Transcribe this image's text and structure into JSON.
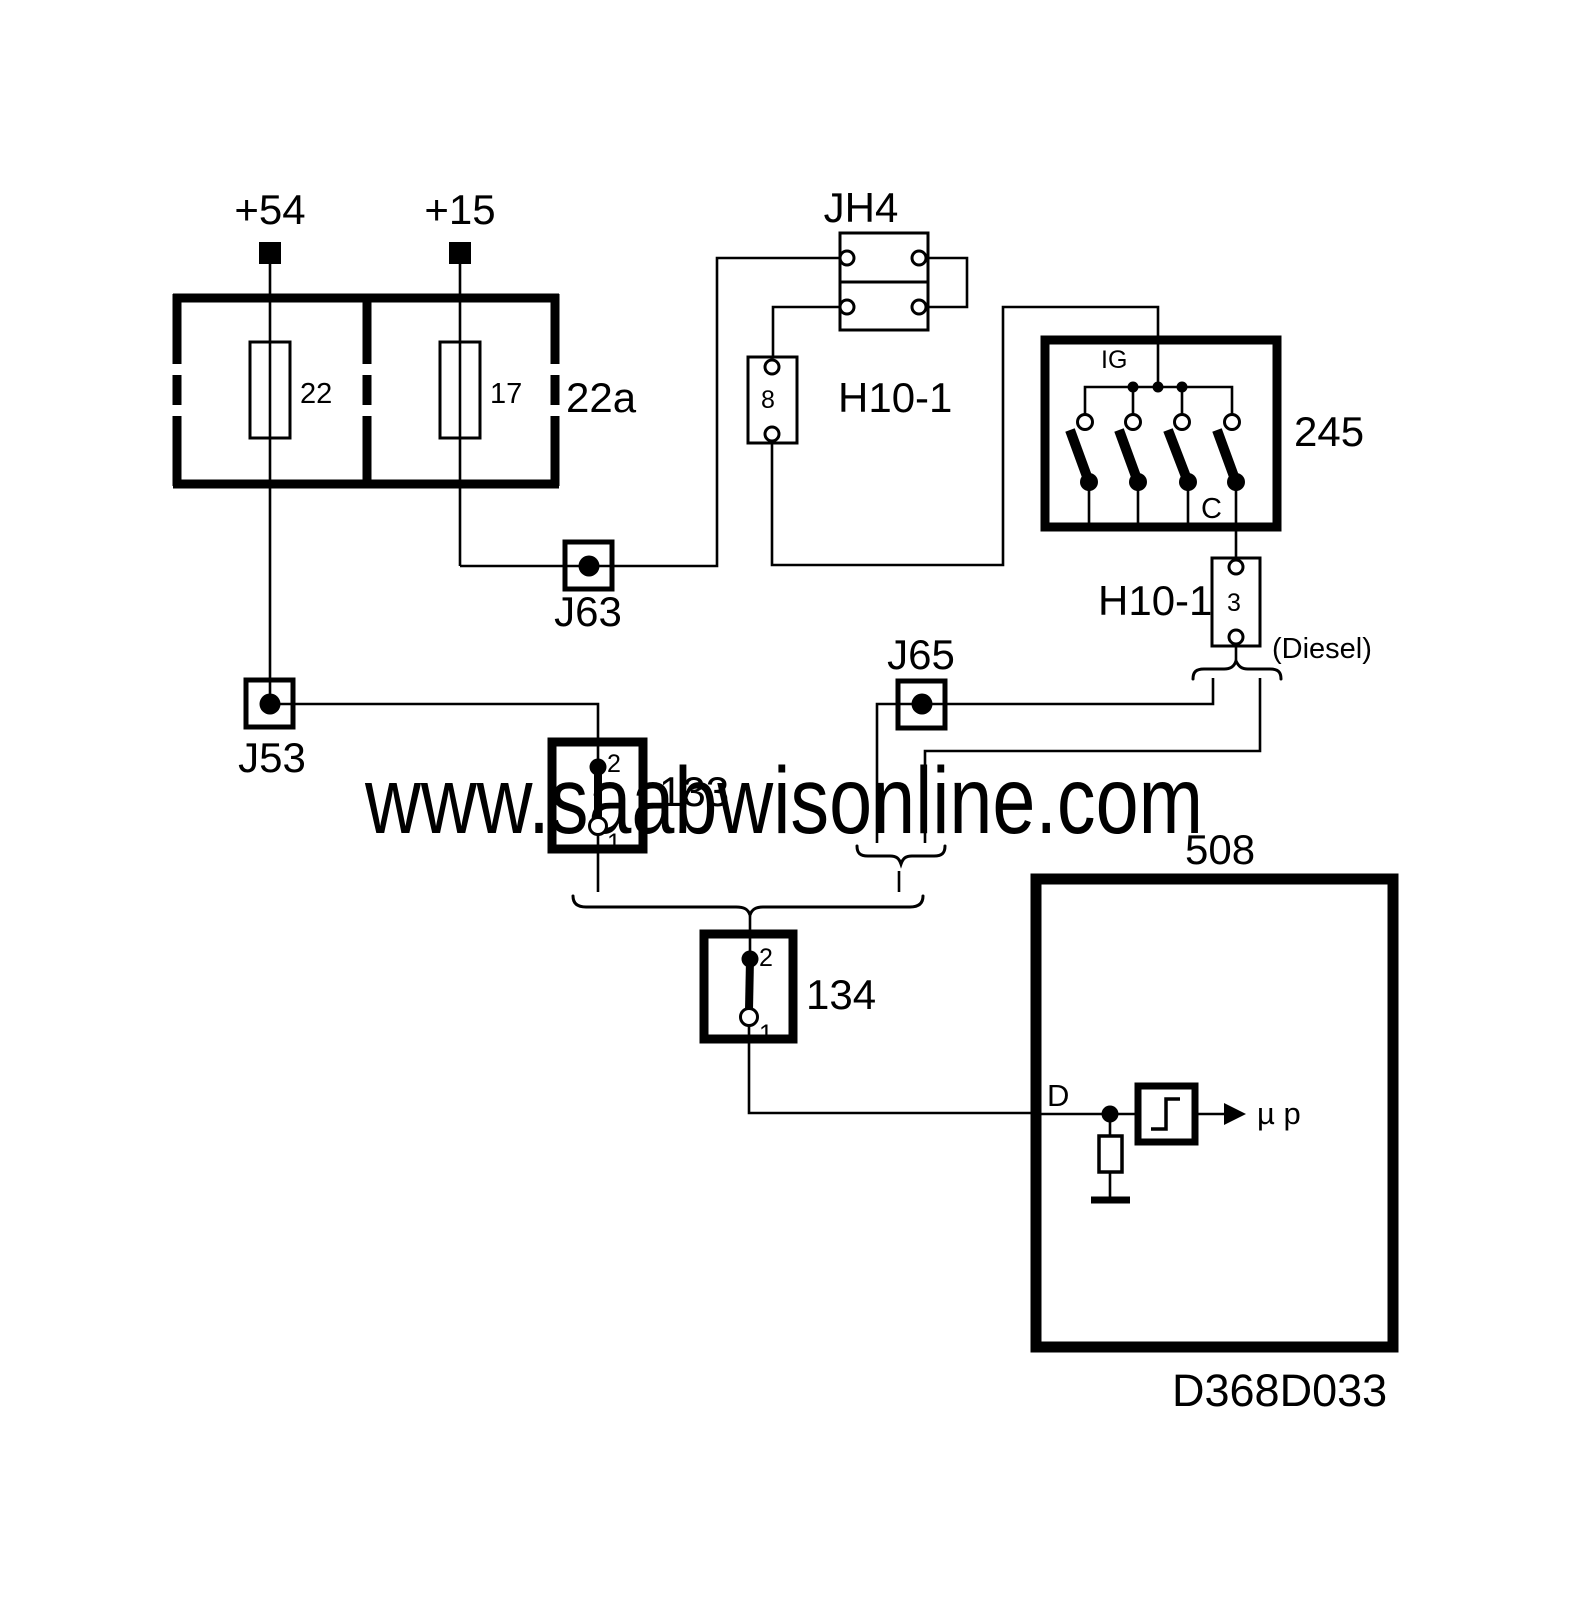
{
  "diagram": {
    "watermark": {
      "text": "www.saabwisonline.com",
      "color": "#9aa3a5"
    },
    "drawing_number": "D368D033",
    "line_color": "#000000",
    "power": {
      "terminal_left": "+54",
      "terminal_right": "+15"
    },
    "fusebox": {
      "label": "22a",
      "fuse_left": "22",
      "fuse_right": "17"
    },
    "jh4": {
      "label": "JH4"
    },
    "h10_1_upper": {
      "label": "H10-1",
      "pin": "8"
    },
    "ignition_switch": {
      "label": "245",
      "bus_label": "IG",
      "output_label": "C"
    },
    "h10_1_lower": {
      "label": "H10-1",
      "pin": "3",
      "variant_note": "(Diesel)"
    },
    "junction_j63": {
      "label": "J63"
    },
    "junction_j53": {
      "label": "J53"
    },
    "junction_j65": {
      "label": "J65"
    },
    "switch_133": {
      "label": "133",
      "pin_top": "2",
      "pin_bottom": "1"
    },
    "switch_134": {
      "label": "134",
      "pin_top": "2",
      "pin_bottom": "1"
    },
    "ecu": {
      "label": "508",
      "pin_label": "D",
      "processor_label": "µ p"
    }
  }
}
